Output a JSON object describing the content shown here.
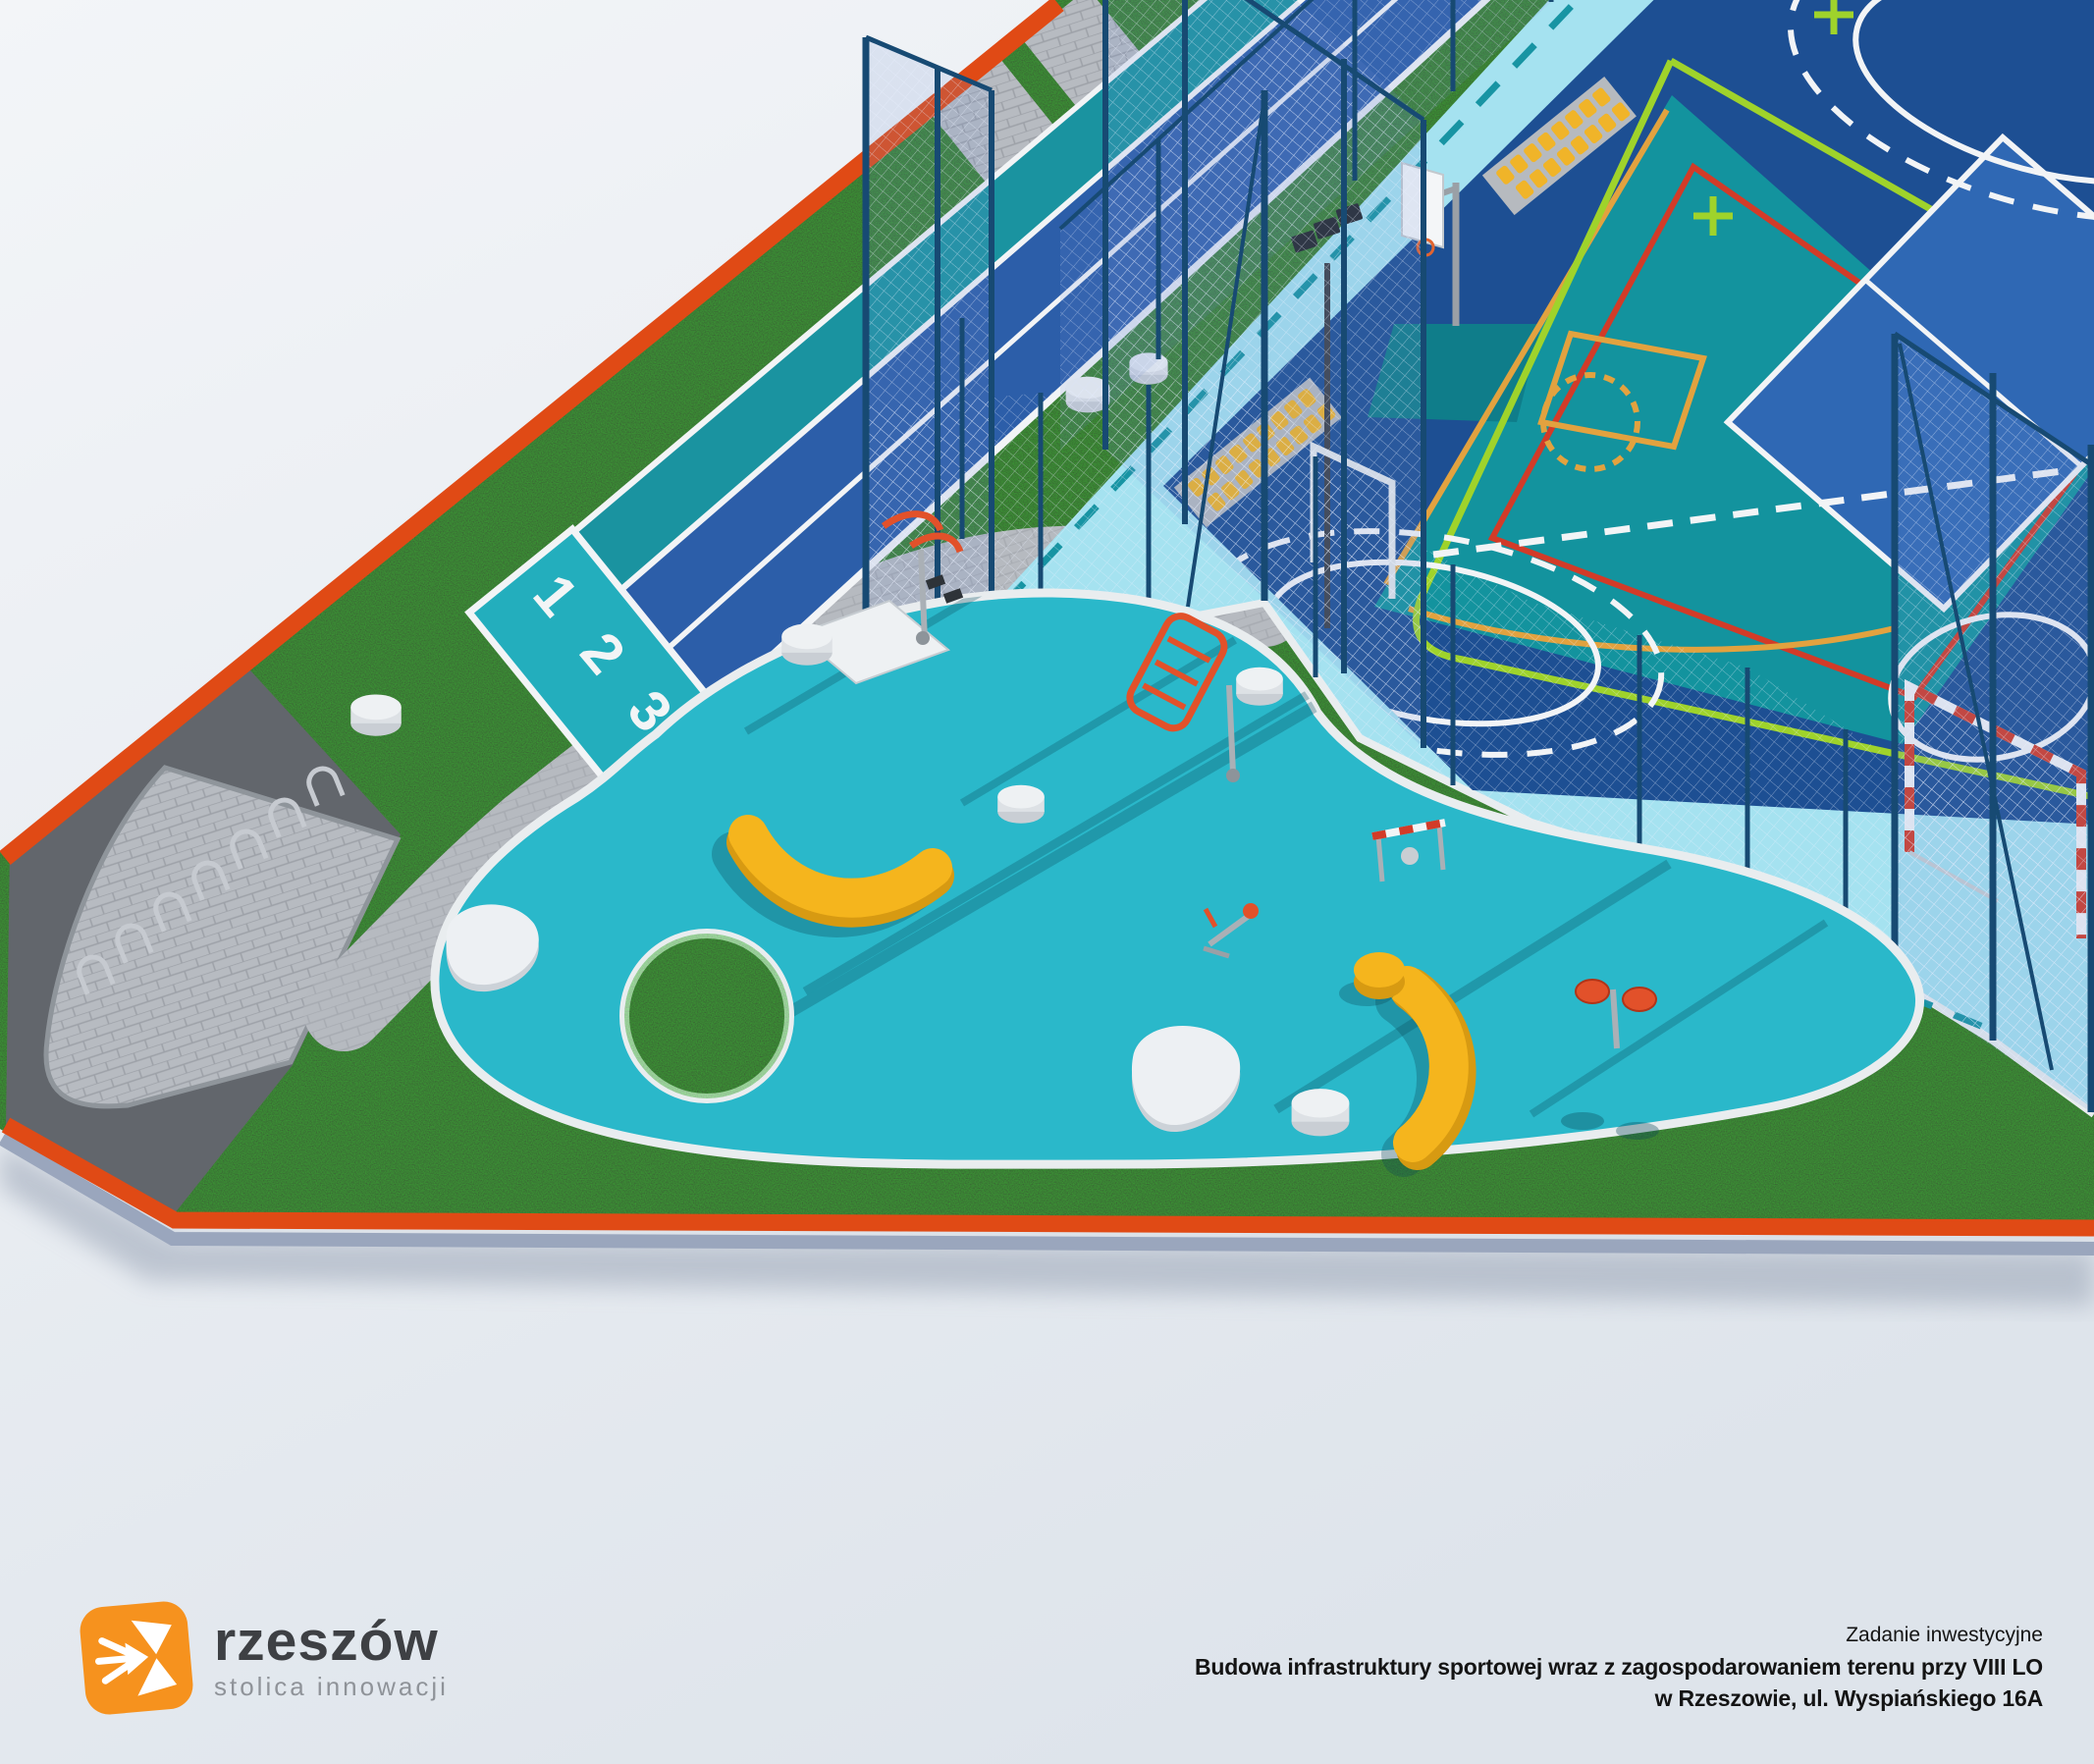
{
  "track": {
    "lane_numbers": [
      "1",
      "2",
      "3"
    ]
  },
  "scene": {
    "colors": {
      "background_top": "#f3f5f8",
      "background_bottom": "#dee4eb",
      "border_orange": "#e04a15",
      "grass": "#2f5429",
      "asphalt": "#62666c",
      "pavers": "#b7bbc1",
      "track_teal": "#1a93a0",
      "track_blue": "#2c5ea9",
      "start_square_teal": "#23aebd",
      "lane_line_white": "#f2f4f6",
      "fitness_pad_turquoise": "#2ab8ca",
      "court_apron_light_blue": "#a5e2f0",
      "court_navy": "#1d4f93",
      "court_mid_blue": "#2f68b4",
      "court_teal": "#13939e",
      "marking_green": "#9fd32b",
      "marking_orange": "#e2a23f",
      "marking_red": "#d23b28",
      "fence_navy": "#174a73",
      "bench_yellow": "#f5b51d",
      "equipment_orange": "#e2512a",
      "stool_white": "#edf0f3",
      "logo_orange": "#f6921e"
    }
  },
  "footer": {
    "logo": {
      "name": "rzeszów",
      "tagline": "stolica innowacji"
    },
    "project": {
      "label": "Zadanie inwestycyjne",
      "line1": "Budowa infrastruktury sportowej wraz z zagospodarowaniem terenu przy VIII LO",
      "line2": "w Rzeszowie, ul. Wyspiańskiego 16A"
    }
  }
}
